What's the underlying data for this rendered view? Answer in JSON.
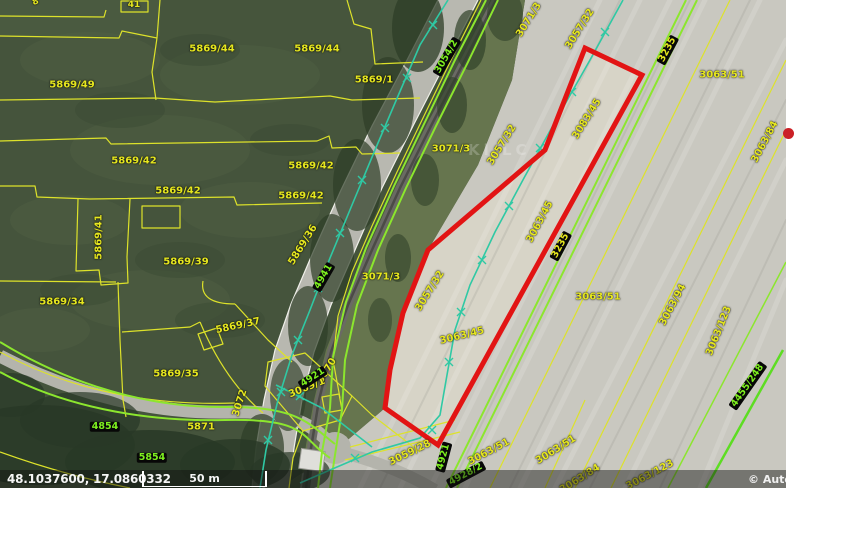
{
  "map": {
    "watermark": "Kl LC",
    "colors": {
      "selection_red": "#e21414",
      "parcel_line_yellow": "#dde22a",
      "road_line_green": "#8ce62e",
      "utility_line_teal": "#2fc9a4",
      "label_yellow": "#e6e71f",
      "label_green_on_black": "#7ef01f",
      "marker_dot_red": "#cb2026"
    },
    "labels": [
      {
        "text": "5869/44",
        "x": 212,
        "y": 49,
        "rot": 0,
        "style": "yellow"
      },
      {
        "text": "5869/44",
        "x": 317,
        "y": 49,
        "rot": 0,
        "style": "yellow"
      },
      {
        "text": "5869/49",
        "x": 72,
        "y": 85,
        "rot": 0,
        "style": "yellow"
      },
      {
        "text": "5869/1",
        "x": 374,
        "y": 80,
        "rot": 0,
        "style": "yellow"
      },
      {
        "text": "5869/42",
        "x": 134,
        "y": 161,
        "rot": 0,
        "style": "yellow"
      },
      {
        "text": "5869/42",
        "x": 311,
        "y": 166,
        "rot": 0,
        "style": "yellow"
      },
      {
        "text": "5869/42",
        "x": 178,
        "y": 191,
        "rot": 0,
        "style": "yellow"
      },
      {
        "text": "5869/42",
        "x": 301,
        "y": 196,
        "rot": 0,
        "style": "yellow"
      },
      {
        "text": "5869/41",
        "x": 99,
        "y": 237,
        "rot": -90,
        "style": "yellow"
      },
      {
        "text": "5869/39",
        "x": 186,
        "y": 262,
        "rot": 0,
        "style": "yellow"
      },
      {
        "text": "5869/36",
        "x": 303,
        "y": 245,
        "rot": -58,
        "style": "yellow"
      },
      {
        "text": "5869/34",
        "x": 62,
        "y": 302,
        "rot": 0,
        "style": "yellow"
      },
      {
        "text": "5869/37",
        "x": 238,
        "y": 326,
        "rot": -12,
        "style": "yellow"
      },
      {
        "text": "5869/35",
        "x": 176,
        "y": 374,
        "rot": 0,
        "style": "yellow"
      },
      {
        "text": "5871",
        "x": 201,
        "y": 427,
        "rot": 0,
        "style": "yellow"
      },
      {
        "text": "3072",
        "x": 240,
        "y": 403,
        "rot": -72,
        "style": "yellow"
      },
      {
        "text": "3070",
        "x": 327,
        "y": 371,
        "rot": -58,
        "style": "yellow"
      },
      {
        "text": "3069/1",
        "x": 307,
        "y": 388,
        "rot": -22,
        "style": "yellow"
      },
      {
        "text": "3071/3",
        "x": 381,
        "y": 277,
        "rot": 0,
        "style": "yellow"
      },
      {
        "text": "3071/3",
        "x": 451,
        "y": 149,
        "rot": 0,
        "style": "yellow"
      },
      {
        "text": "3071/3",
        "x": 529,
        "y": 20,
        "rot": -58,
        "style": "yellow"
      },
      {
        "text": "3057/32",
        "x": 430,
        "y": 291,
        "rot": -58,
        "style": "yellow"
      },
      {
        "text": "3057/32",
        "x": 502,
        "y": 145,
        "rot": -58,
        "style": "yellow"
      },
      {
        "text": "3057/32",
        "x": 580,
        "y": 29,
        "rot": -58,
        "style": "yellow"
      },
      {
        "text": "3063/45",
        "x": 462,
        "y": 336,
        "rot": -14,
        "style": "yellow"
      },
      {
        "text": "3083/45",
        "x": 587,
        "y": 119,
        "rot": -58,
        "style": "yellow"
      },
      {
        "text": "3063/45",
        "x": 540,
        "y": 222,
        "rot": -62,
        "style": "yellow"
      },
      {
        "text": "3063/51",
        "x": 722,
        "y": 75,
        "rot": 0,
        "style": "yellow"
      },
      {
        "text": "3063/51",
        "x": 598,
        "y": 297,
        "rot": 0,
        "style": "yellow"
      },
      {
        "text": "3063/94",
        "x": 673,
        "y": 305,
        "rot": -62,
        "style": "yellow"
      },
      {
        "text": "3063/123",
        "x": 719,
        "y": 331,
        "rot": -68,
        "style": "yellow"
      },
      {
        "text": "3063/84",
        "x": 765,
        "y": 142,
        "rot": -62,
        "style": "yellow"
      },
      {
        "text": "3059/28",
        "x": 410,
        "y": 453,
        "rot": -26,
        "style": "yellow"
      },
      {
        "text": "3063/51",
        "x": 489,
        "y": 452,
        "rot": -28,
        "style": "yellow"
      },
      {
        "text": "3063/51",
        "x": 556,
        "y": 450,
        "rot": -32,
        "style": "yellow"
      },
      {
        "text": "3063/84",
        "x": 580,
        "y": 479,
        "rot": -32,
        "style": "yellow"
      },
      {
        "text": "3063/123",
        "x": 650,
        "y": 475,
        "rot": -28,
        "style": "yellow"
      },
      {
        "text": "41",
        "x": 134,
        "y": 6,
        "rot": 0,
        "style": "yellow",
        "size": 9
      },
      {
        "text": "8",
        "x": 36,
        "y": 3,
        "rot": -20,
        "style": "yellow",
        "size": 9
      },
      {
        "text": "4854",
        "x": 105,
        "y": 427,
        "rot": 0,
        "style": "black-green"
      },
      {
        "text": "5854",
        "x": 152,
        "y": 458,
        "rot": 0,
        "style": "black-green"
      },
      {
        "text": "4921",
        "x": 313,
        "y": 378,
        "rot": -33,
        "style": "black-green"
      },
      {
        "text": "3054/2",
        "x": 447,
        "y": 57,
        "rot": -60,
        "style": "black-green"
      },
      {
        "text": "4941",
        "x": 324,
        "y": 277,
        "rot": -60,
        "style": "black-green"
      },
      {
        "text": "4921",
        "x": 444,
        "y": 457,
        "rot": -75,
        "style": "black-green"
      },
      {
        "text": "4928/2",
        "x": 466,
        "y": 475,
        "rot": -28,
        "style": "black-green"
      },
      {
        "text": "4455/248",
        "x": 748,
        "y": 386,
        "rot": -55,
        "style": "black-green"
      },
      {
        "text": "3235",
        "x": 668,
        "y": 50,
        "rot": -62,
        "style": "black-yellow"
      },
      {
        "text": "3235",
        "x": 561,
        "y": 246,
        "rot": -62,
        "style": "black-yellow"
      }
    ]
  },
  "statusbar": {
    "coordinates": "48.1037600, 17.0860332",
    "scale_label": "50 m",
    "copyright": "© Autor"
  }
}
